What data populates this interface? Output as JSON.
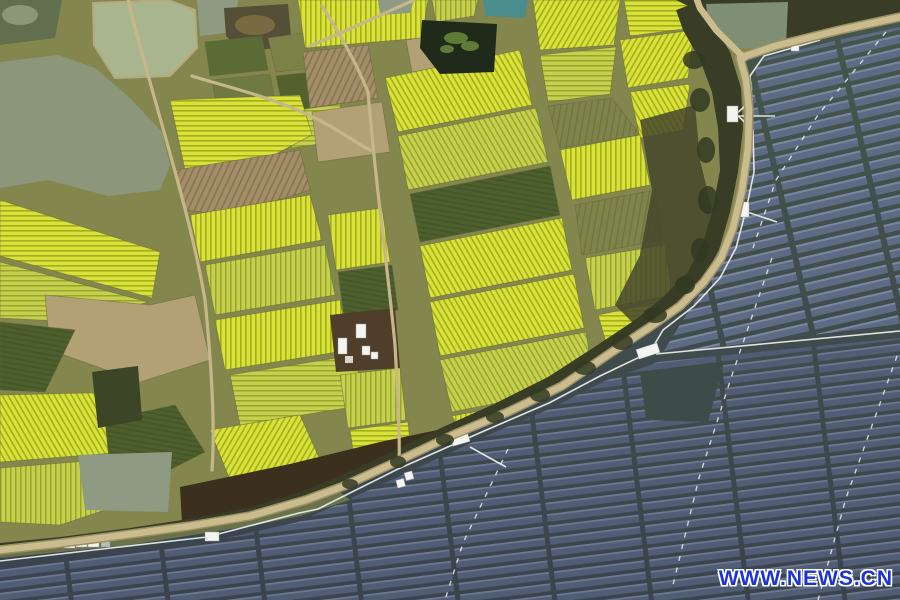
{
  "image": {
    "title": "Aerial view of rapeseed flower fields beside a water-surface solar power station",
    "width": 900,
    "height": 600
  },
  "watermark": {
    "text": "WWW.NEWS.CN"
  },
  "colors": {
    "olive-base": "#83874e",
    "olive-field": "#7f834c",
    "olive-stripe": "#72763e",
    "yellow-bright": "#d9e13b",
    "yellow-stripe": "#a2ae1c",
    "yellow-soft": "#c7d04e",
    "yellow-soft-stripe": "#98a52c",
    "brown-plow": "#a28e68",
    "brown-stripe": "#8b7550",
    "tan-bare": "#b2a175",
    "green-dark": "#4e5f2e",
    "green-dark-stripe": "#445426",
    "hedge-line": "#62653a",
    "canal": "#8b967a",
    "pond-sage": "#a9b58f",
    "pond-gray": "#8e9a82",
    "pond-olive": "#616f4e",
    "pond-dark": "#1f2a1a",
    "pond-teal": "#4b8c8c",
    "plant-green": "#5f7c36",
    "bank-tan": "#b7a97c",
    "marsh": "#3b2f1e",
    "tree-band": "#3a3d26",
    "scrub": "#45472c",
    "tree-blob": "#333a22",
    "berm": "#6b7148",
    "road-tan": "#cbbc8e",
    "road-edge": "#9b9168",
    "farm-road": "#c6b78a",
    "solar-water-top": "#46564b",
    "solar-water-mid": "#3e4c49",
    "solar-water-bottom": "#3a434e",
    "panel-a": "#5e6b85",
    "panel-a-edge": "#7b87a0",
    "panel-b": "#515d74",
    "panel-b-edge": "#6d7890",
    "fence-white": "#e9ece8",
    "building-white": "#f4f5f1",
    "watermark-blue": "#1b34d2"
  },
  "scene": {
    "regions": [
      "rapeseed-field-patchwork",
      "plowed-fields",
      "vegetable-gardens",
      "ponds",
      "canal",
      "farm-roads",
      "boundary-road",
      "tree-line",
      "marsh",
      "farm-building-cluster",
      "solar-array-upper",
      "solar-array-lower",
      "inverter-stations",
      "fence-walkway",
      "cable-lines"
    ]
  }
}
